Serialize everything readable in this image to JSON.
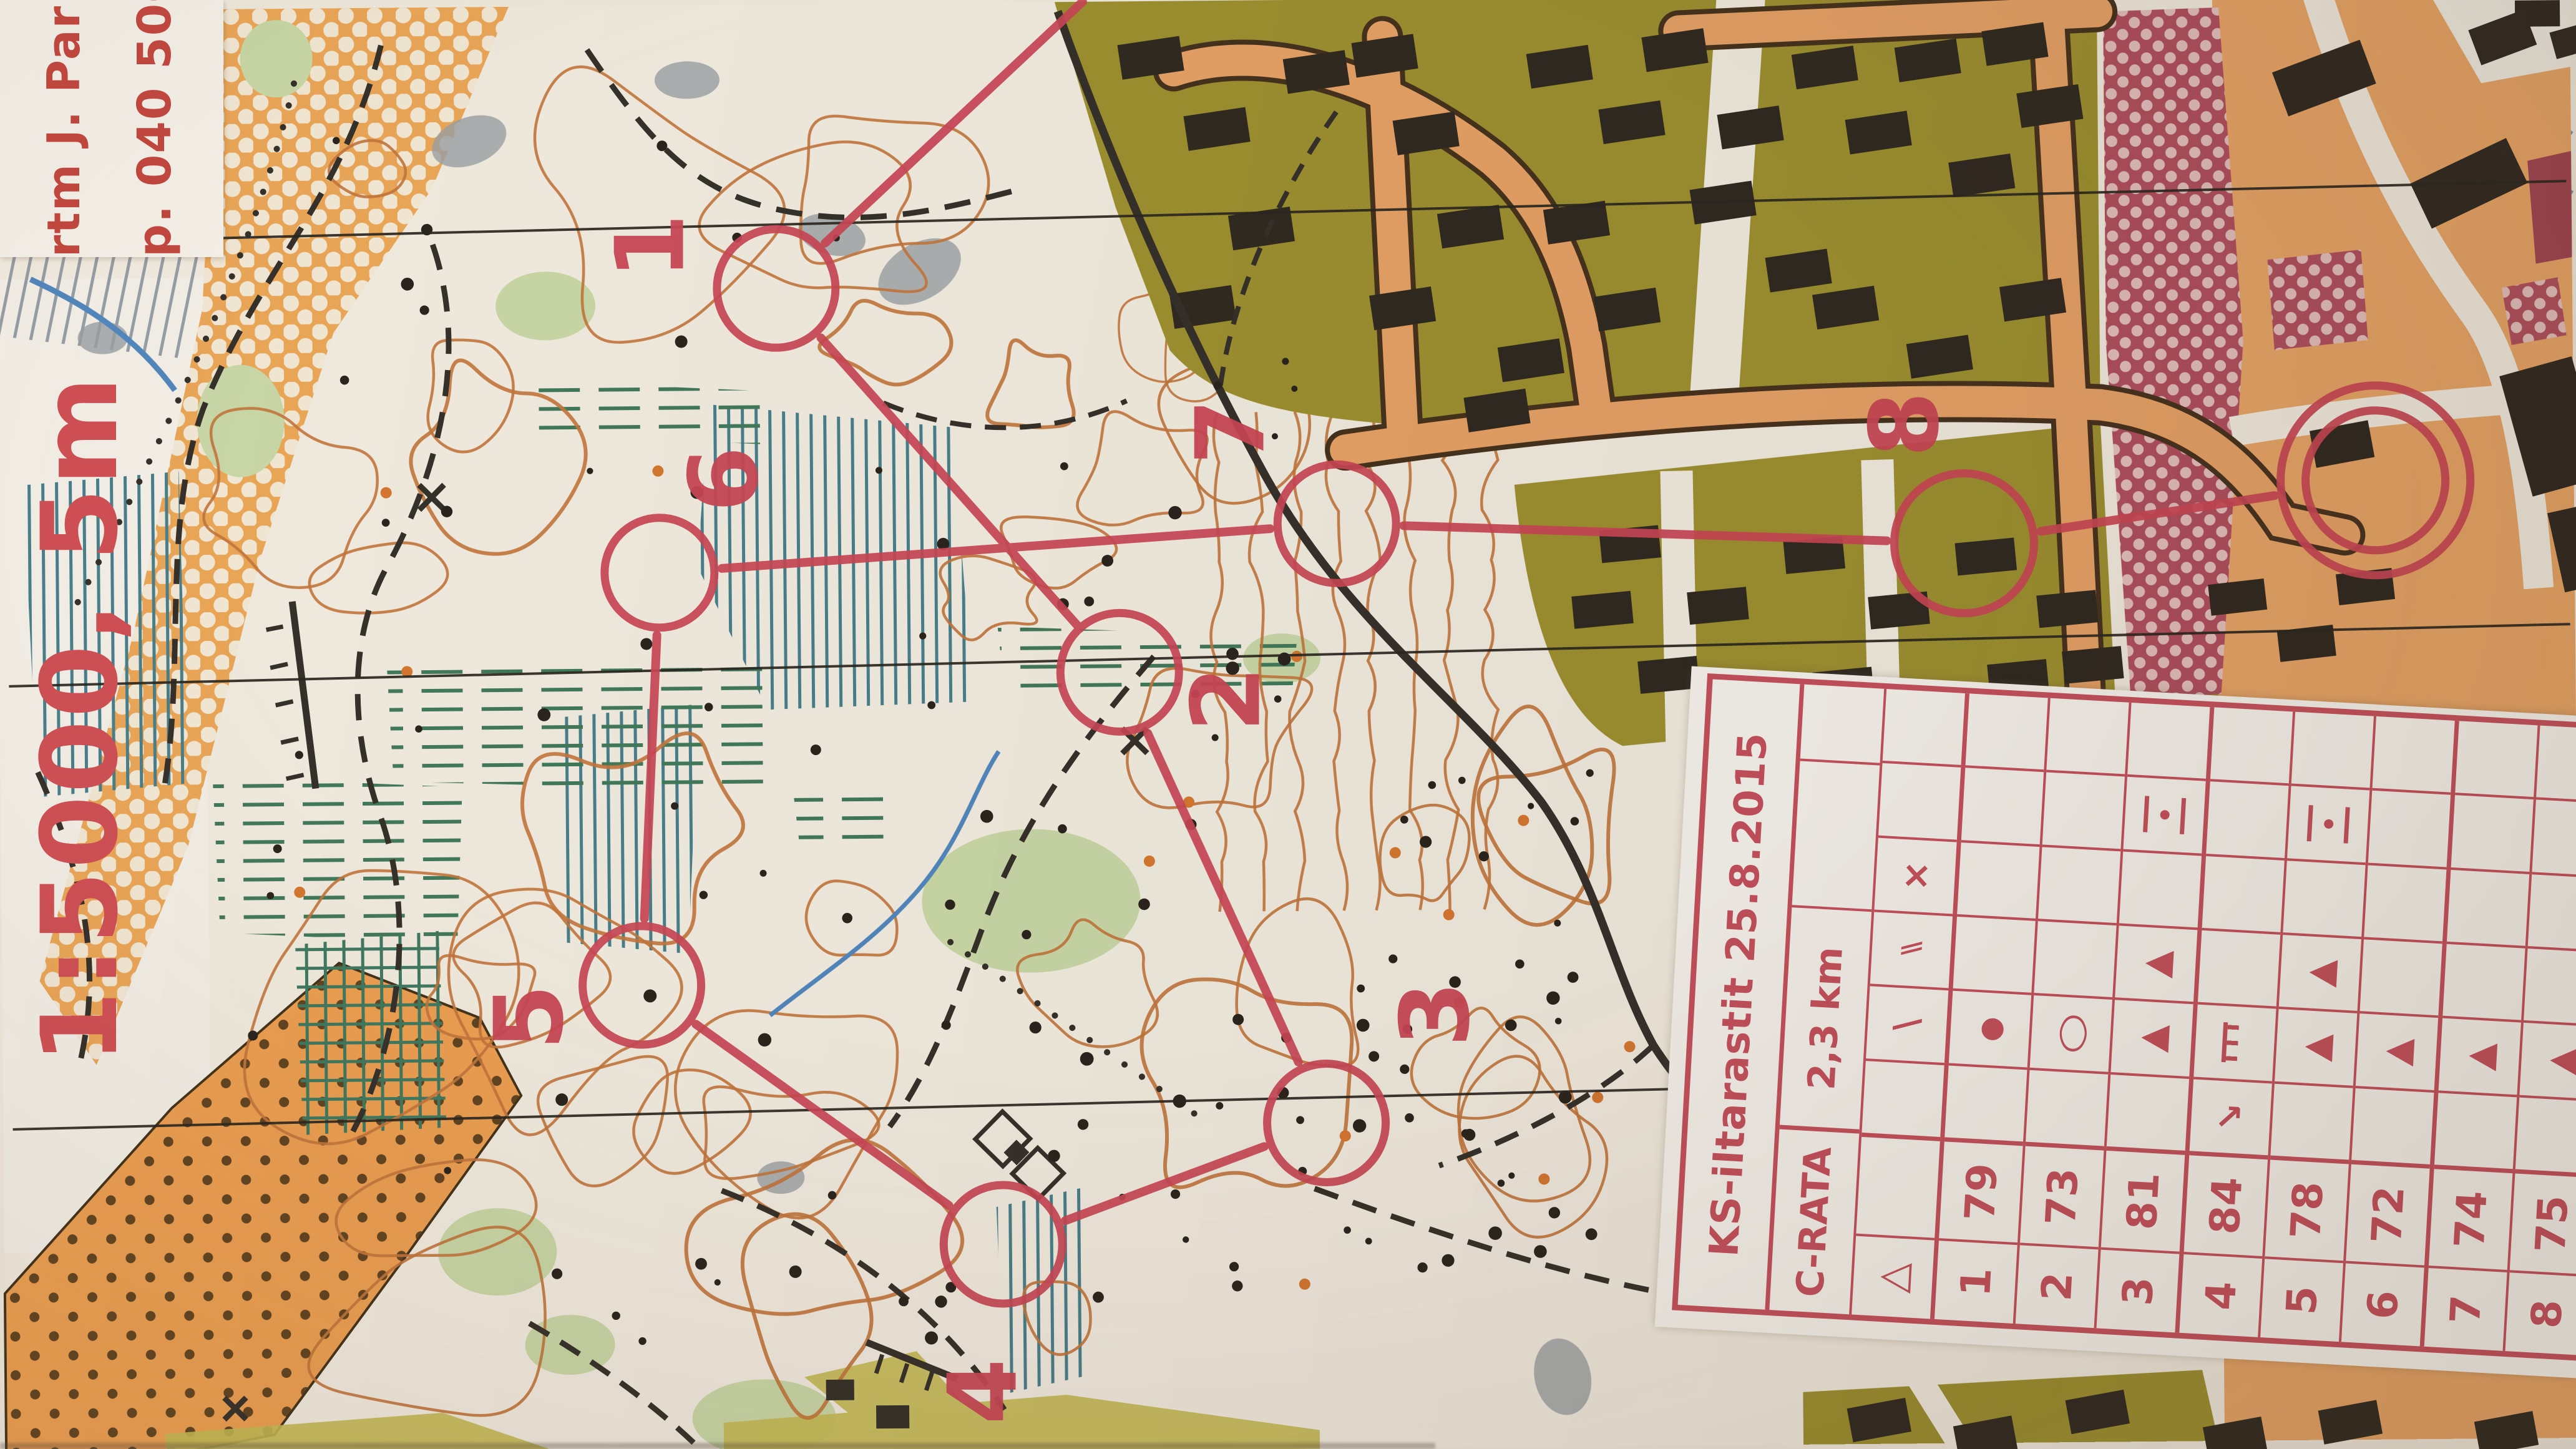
{
  "photo_type": "orienteering course map photo",
  "map": {
    "attribution_line1": "rtm J. Par",
    "attribution_line2": "p. 040 500",
    "scale_label": "1:5000, 5m"
  },
  "course": {
    "start_symbol": "△",
    "controls": [
      {
        "number": "1",
        "code": "79"
      },
      {
        "number": "2",
        "code": "73"
      },
      {
        "number": "3",
        "code": "81"
      },
      {
        "number": "4",
        "code": "84"
      },
      {
        "number": "5",
        "code": "78"
      },
      {
        "number": "6",
        "code": "72"
      },
      {
        "number": "7",
        "code": "74"
      },
      {
        "number": "8",
        "code": "75"
      }
    ]
  },
  "control_card": {
    "title": "KS-iltarastit 25.8.2015",
    "course_name": "C-RATA",
    "course_length": "2,3 km",
    "rows": [
      {
        "num": "△",
        "code": "",
        "sym": {
          "D": "slash",
          "E": "double-slash",
          "F": "cross"
        }
      },
      {
        "num": "1",
        "code": "79",
        "sym": {
          "D": "knoll"
        }
      },
      {
        "num": "2",
        "code": "73",
        "sym": {
          "D": "depression"
        }
      },
      {
        "num": "3",
        "code": "81",
        "sym": {
          "D": "boulder",
          "E": "boulder",
          "G": "between"
        }
      },
      {
        "num": "4",
        "code": "84",
        "sym": {
          "C": "arrow",
          "D": "fence"
        }
      },
      {
        "num": "5",
        "code": "78",
        "sym": {
          "D": "boulder",
          "E": "boulder",
          "G": "between"
        }
      },
      {
        "num": "6",
        "code": "72",
        "sym": {
          "D": "boulder"
        }
      },
      {
        "num": "7",
        "code": "74",
        "sym": {
          "D": "boulder"
        }
      },
      {
        "num": "8",
        "code": "75",
        "sym": {
          "D": "boulder"
        }
      }
    ]
  },
  "colors": {
    "course_overprint": "#cb4556",
    "card_red": "#c8505e",
    "label_red": "#c4453e",
    "contour_orange": "#c4763b",
    "settlement_olive": "#9e9230",
    "road_orange": "#eaa468",
    "building_black": "#2c2720",
    "rough_open_orange": "#f0a855",
    "marsh_teal": "#45808e",
    "multistorey_maroon": "#b04d5e",
    "paper": "#f4efe4"
  }
}
